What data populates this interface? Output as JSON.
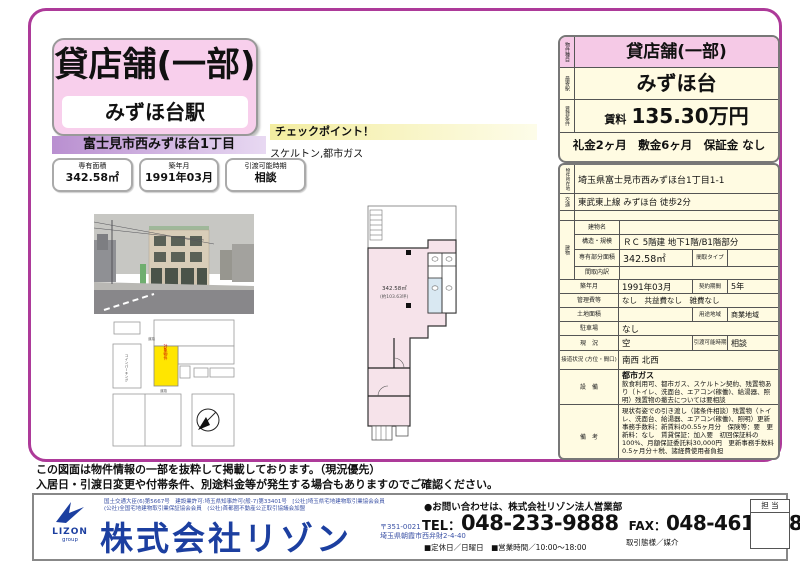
{
  "header": {
    "property_type": "貸店舗(一部)",
    "station": "みずほ台駅",
    "address_bar": "富士見市西みずほ台1丁目",
    "chips": [
      {
        "label": "専有面積",
        "value": "342.58㎡"
      },
      {
        "label": "築年月",
        "value": "1991年03月"
      },
      {
        "label": "引渡可能時期",
        "value": "相談"
      }
    ]
  },
  "checkpoint": {
    "title": "チェックポイント！",
    "text": "スケルトン,都市ガス"
  },
  "floorplan": {
    "area": "342.58㎡",
    "area_sub": "(約103.63坪)"
  },
  "sitemap": {
    "parking_label": "コインパーキング",
    "subject_label": "対象物件",
    "road_label": "道路"
  },
  "summary_card": {
    "rows": [
      {
        "label": "物件種目",
        "value": "貸店舗(一部)"
      },
      {
        "label": "最寄駅",
        "value": "みずほ台"
      },
      {
        "label": "賃貸条件",
        "rent_label": "賃料",
        "rent_value": "135.30万円"
      }
    ],
    "terms": "礼金2ヶ月　敷金6ヶ月　保証金 なし"
  },
  "detail_table": {
    "location_label": "物件所在地",
    "location": "埼玉県富士見市西みずほ台1丁目1-1",
    "access_label": "交通",
    "access": "東武東上線 みずほ台 徒歩2分",
    "building_label": "建物",
    "building_name_label": "建物名",
    "building_name": "",
    "structure_label": "構造・規模",
    "structure": "ＲＣ 5階建 地下1階/B1階部分",
    "area_label": "専有部分面積",
    "area": "342.58㎡",
    "layout_type_label": "間取タイプ",
    "layout_type": "",
    "layout_detail_label": "間取内訳",
    "layout_detail": "",
    "built_label": "築年月",
    "built": "1991年03月",
    "contract_label": "契約期間",
    "contract": "5年",
    "fees_label": "管理費等",
    "fees": "なし　共益費なし　雑費なし",
    "land_label": "土地面積",
    "land": "",
    "zoning_label": "用途地域",
    "zoning": "商業地域",
    "parking_label": "駐車場",
    "parking": "なし",
    "status_label": "現　況",
    "status": "空",
    "handover_label": "引渡可能時期",
    "handover": "相談",
    "road_label": "接道状況 (方位・間口)",
    "road": "南西 北西",
    "equipment_label": "設　備",
    "equipment_line1": "都市ガス",
    "equipment_line2": "飲食利用可、都市ガス、スケルトン契約、残置物あり（トイレ、洗面台、エアコン(稼働)、給湯器、照明）残置物の撤去については要相談",
    "remarks_label": "備　考",
    "remarks": "現状有姿での引き渡し（諸条件相談）残置物（トイレ、洗面台、給湯器、エアコン(稼働)、照明）更新事務手数料：新賃料の0.55ヶ月分　保険等：要　更新料：なし　賃貸保証：加入要　初回保証料の100%、月額保証委託料30,000円　更新事務手数料0.5ヶ月分＋税、諸経費使用者負担"
  },
  "disclaimer": {
    "line1": "この図面は物件情報の一部を抜粋して掲載しております。（現況優先）",
    "line2": "入居日・引渡日変更や付帯条件、別途料金等が発生する場合もありますのでご確認ください。"
  },
  "footer": {
    "license_line1": "国土交通大臣(6)第5667号　建設業許可:埼玉県知事許可(般-7)第33401号　[公社]埼玉県宅地建物取引業協会会員",
    "license_line2": "(公社)全国宅地建物取引業保証協会会員　(公社)首都圏不動産公正取引協議会加盟",
    "company": "株式会社リゾン",
    "logo_name": "LIZON",
    "logo_sub": "group",
    "postal": "〒351-0021",
    "address": "埼玉県朝霞市西弁財2-4-40",
    "inquiry": "●お問い合わせは、株式会社リゾン法人営業部",
    "tel_label": "TEL：",
    "tel": "048-233-9888",
    "fax_label": "FAX：",
    "fax": "048-461-3788",
    "hours": "■定休日／日曜日　■営業時間／10:00～18:00",
    "deal_type": "取引態様／媒介",
    "staff_label": "担 当"
  }
}
